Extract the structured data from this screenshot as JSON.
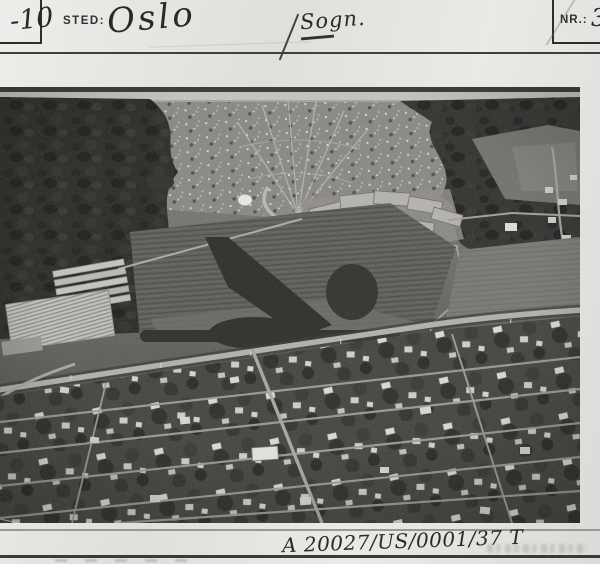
{
  "card": {
    "serial_fragment": "-10",
    "place_label": "STED:",
    "place_value": "Oslo",
    "annotation": "Sogn.",
    "nr_label": "NR.:",
    "nr_value": "3"
  },
  "photo": {
    "type": "black-and-white aerial photograph",
    "scene": "Aerial view over a garden suburb in Oslo: dense grid of small villas with trees in the foreground, a light main road crossing diagonally, allotment fields and greenhouse nursery in the middle distance, apartment blocks under construction and forest behind, housing estate on the far hillside"
  },
  "footer": {
    "reference_code": "A 20027/US/0001/37 T"
  },
  "colors": {
    "paper": "#e8e6e3",
    "ink": "#2e2d2a",
    "rule": "#3b3a37",
    "photo_dark": "#2c2b28",
    "photo_light": "#c4c3bf"
  }
}
